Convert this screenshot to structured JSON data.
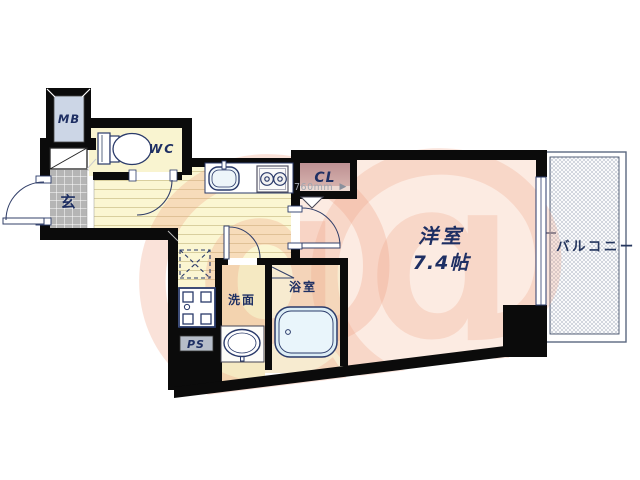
{
  "plan": {
    "title": "apartment-floor-plan",
    "rooms": {
      "mb_label": "MB",
      "wc_label": "WC",
      "entrance_label": "玄",
      "closet_label": "CL",
      "main_room_name": "洋室",
      "main_room_size": "7.4帖",
      "washroom_label": "洗面",
      "bathroom_label": "浴室",
      "pipe_space_label": "PS",
      "balcony_label": "バルコニー"
    },
    "dimensions": {
      "closet_width": "760mm",
      "closet_arrow": "▶"
    },
    "watermark_glyph": "@",
    "colors": {
      "wall": "#0b0b0b",
      "main_room_fill": "#fcebe2",
      "wc_fill": "#f9f4d0",
      "hall_fill": "#fbf6d2",
      "hall_stripe": "#d9cf9e",
      "tile_fill": "#b5b5b5",
      "mb_fill": "#ccd6e6",
      "closet_fill": "#c59a9c",
      "label_navy": "#1e2f63",
      "watermark_pink": "#f0a285",
      "balcony_border": "#5a6880"
    }
  }
}
